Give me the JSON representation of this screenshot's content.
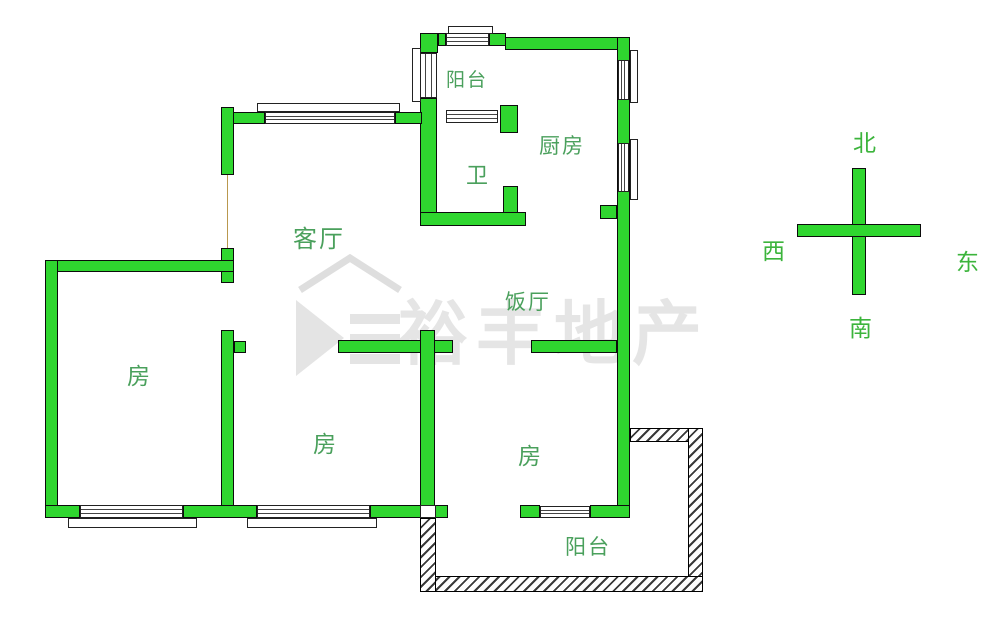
{
  "rooms": {
    "balcony_top": "阳台",
    "kitchen": "厨房",
    "bathroom": "卫",
    "living_room": "客厅",
    "dining_room": "饭厅",
    "bedroom_left": "房",
    "bedroom_middle": "房",
    "bedroom_right": "房",
    "balcony_bottom": "阳台"
  },
  "compass": {
    "north": "北",
    "south": "南",
    "east": "东",
    "west": "西"
  },
  "watermark": {
    "text": "裕丰地产"
  },
  "colors": {
    "wall_green": "#2fd62f",
    "room_label_green": "#4aa05c",
    "compass_green": "#3cb43c",
    "outline_black": "#0c0c0c",
    "watermark_gray": "#e5e5e5"
  }
}
